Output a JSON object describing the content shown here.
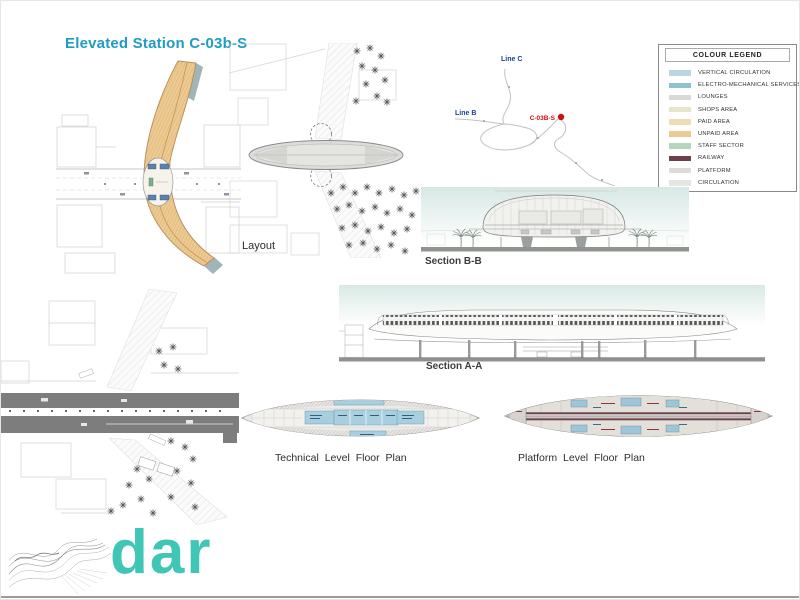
{
  "slide": {
    "title": "Elevated Station C-03b-S",
    "title_color": "#1e9cc4"
  },
  "panels": {
    "layout_label": "Layout",
    "section_bb_label": "Section B-B",
    "section_aa_label": "Section A-A",
    "technical_plan_label": "Technical Level Floor Plan",
    "platform_plan_label": "Platform Level Floor Plan"
  },
  "route_map": {
    "line_c_label": "Line C",
    "line_b_label": "Line B",
    "station_label": "C-03B-S",
    "line_label_color": "#1d3f8f",
    "station_color": "#cc1111"
  },
  "legend": {
    "title": "COLOUR LEGEND",
    "items": [
      {
        "label": "VERTICAL CIRCULATION",
        "color": "#b9d7e0"
      },
      {
        "label": "ELECTRO-MECHANICAL SERVICES",
        "color": "#8fc2cf"
      },
      {
        "label": "LOUNGES",
        "color": "#d8d8d4"
      },
      {
        "label": "SHOPS AREA",
        "color": "#e7e5cb"
      },
      {
        "label": "PAID AREA",
        "color": "#efdcb2"
      },
      {
        "label": "UNPAID AREA",
        "color": "#eccb92"
      },
      {
        "label": "STAFF SECTOR",
        "color": "#b7d5bc"
      },
      {
        "label": "RAILWAY",
        "color": "#6e3f4d"
      },
      {
        "label": "PLATFORM",
        "color": "#dcdcd8"
      },
      {
        "label": "CIRCULATION",
        "color": "#e5e5e1"
      }
    ]
  },
  "logo": {
    "text": "dar",
    "color": "#3fc6b7"
  }
}
